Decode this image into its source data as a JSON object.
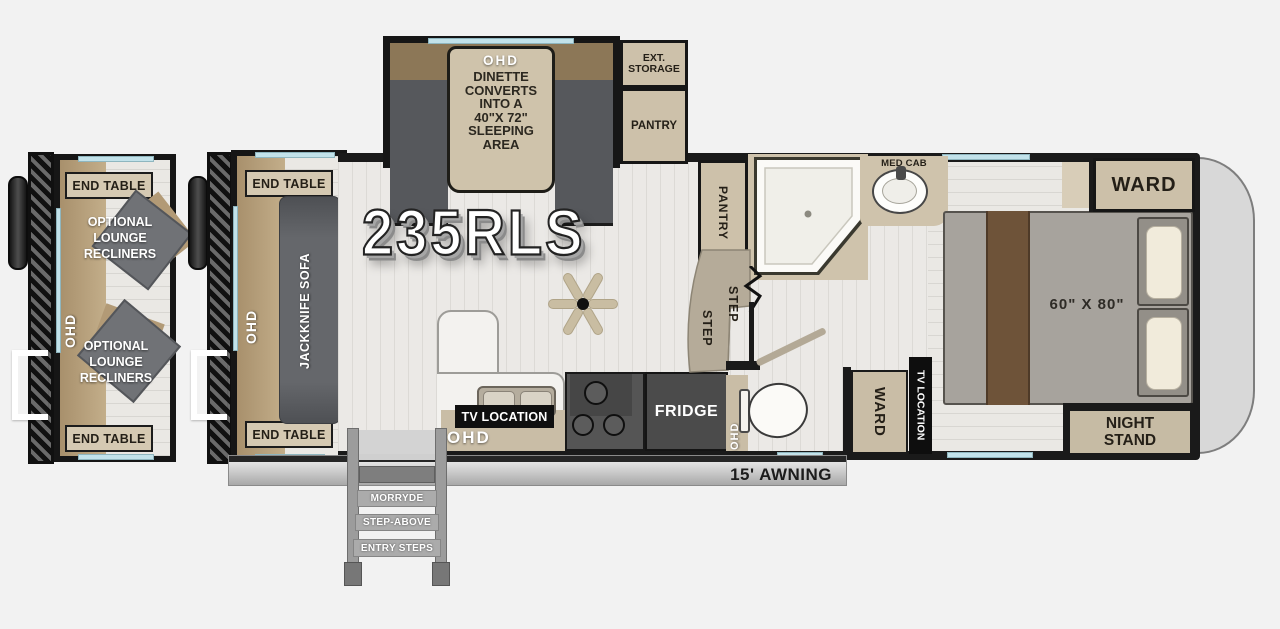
{
  "model": "235RLS",
  "colors": {
    "wall": "#1a1a1a",
    "cabinet_tan": "#cdc1aa",
    "carpet_tan": "#b29a76",
    "sofa_gray": "#5f6165",
    "window_blue": "#c2e2ea",
    "floor_light": "#ebe9e6",
    "bed_gray": "#a7a39d",
    "runner_brown": "#6e5339",
    "appliance_gray": "#4b4b4b",
    "nose_gray": "#d8d8d8"
  },
  "optional_slide": {
    "end_table_top": "END TABLE",
    "ohd": "OHD",
    "recliner_1": [
      "OPTIONAL",
      "LOUNGE",
      "RECLINERS"
    ],
    "recliner_2": [
      "OPTIONAL",
      "LOUNGE",
      "RECLINERS"
    ],
    "end_table_bottom": "END TABLE"
  },
  "sofa_slide": {
    "end_table_top": "END TABLE",
    "ohd": "OHD",
    "sofa": "JACKKNIFE SOFA",
    "end_table_bottom": "END TABLE"
  },
  "dinette_slide": {
    "ohd": "OHD",
    "lines": [
      "DINETTE",
      "CONVERTS",
      "INTO A",
      "40\"X 72\"",
      "SLEEPING",
      "AREA"
    ]
  },
  "front_storage": {
    "ext_storage": [
      "EXT.",
      "STORAGE"
    ],
    "pantry": "PANTRY"
  },
  "kitchen": {
    "tv_location": "TV LOCATION",
    "ohd_counter": "OHD",
    "fridge": "FRIDGE",
    "ohd_strip": "OHD"
  },
  "bath": {
    "pantry": "PANTRY",
    "step_upper": "STEP",
    "step_lower": "STEP",
    "med_cab": "MED CAB"
  },
  "hall": {
    "ward": "WARD",
    "tv_location": "TV LOCATION"
  },
  "bedroom": {
    "ward": "WARD",
    "bed_size": "60\" X 80\"",
    "night_stand": [
      "NIGHT",
      "STAND"
    ]
  },
  "exterior": {
    "awning": "15' AWNING",
    "entry_steps": [
      "MORRYDE",
      "STEP-ABOVE",
      "ENTRY STEPS"
    ]
  }
}
